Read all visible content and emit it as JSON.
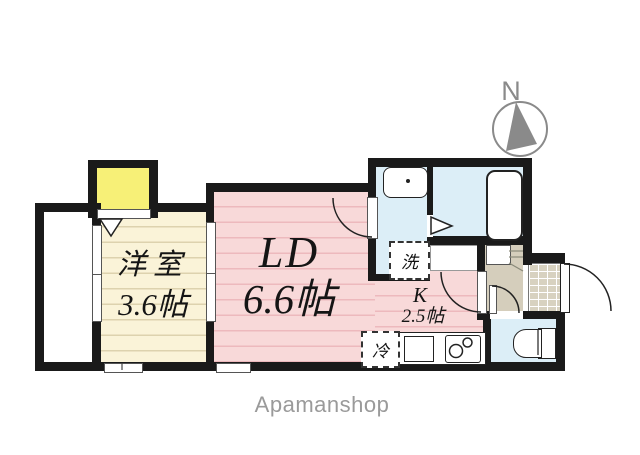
{
  "plan": {
    "compass_label": "N",
    "rooms": [
      {
        "id": "western_room",
        "name": "洋室",
        "size": "3.6帖"
      },
      {
        "id": "living_dining",
        "name": "LD",
        "size": "6.6帖"
      },
      {
        "id": "kitchen",
        "name": "K",
        "size": "2.5帖"
      }
    ],
    "fixtures": {
      "washer_label": "洗",
      "fridge_label": "冷"
    },
    "icons": {
      "compass-needle-icon": "gray triangle pointing north",
      "door-arc-icon": "quarter-circle door swing",
      "folding-door-icon": "outlined triangle"
    },
    "colors": {
      "wall": "#1a1a1a",
      "room_pink": "#f8d9d9",
      "room_cream": "#faf3d8",
      "closet_yellow": "#f7f077",
      "wet_area_blue": "#dceef7",
      "entry_beige": "#d5cebc",
      "brand_gray": "#9a9a9a"
    }
  },
  "footer": {
    "brand": "Apamanshop"
  }
}
